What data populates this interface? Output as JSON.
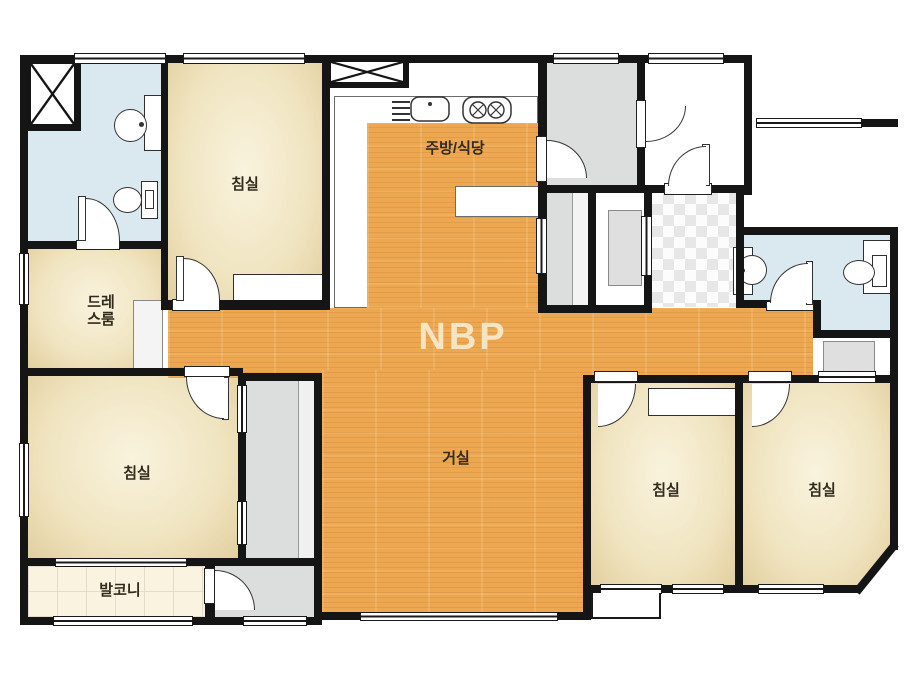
{
  "watermark": "NBP",
  "rooms": {
    "bedroom_top_left": "침실",
    "bedroom_bottom_left": "침실",
    "bedroom_bottom_center": "침실",
    "bedroom_bottom_right": "침실",
    "dress_room": [
      "드레",
      "스룸"
    ],
    "kitchen_dining": "주방/식당",
    "living_room": "거실",
    "balcony": "발코니"
  },
  "colors": {
    "wall": "#151515",
    "wood_floor": "#ECA750",
    "bedroom_floor": "#F0E4C0",
    "bathroom_floor": "#DAE8EF",
    "utility_gray": "#DCDDDD",
    "balcony_floor": "#FAF3DF",
    "entry_checker": "#E7E7E7",
    "watermark_color": "#F5E7C2"
  }
}
